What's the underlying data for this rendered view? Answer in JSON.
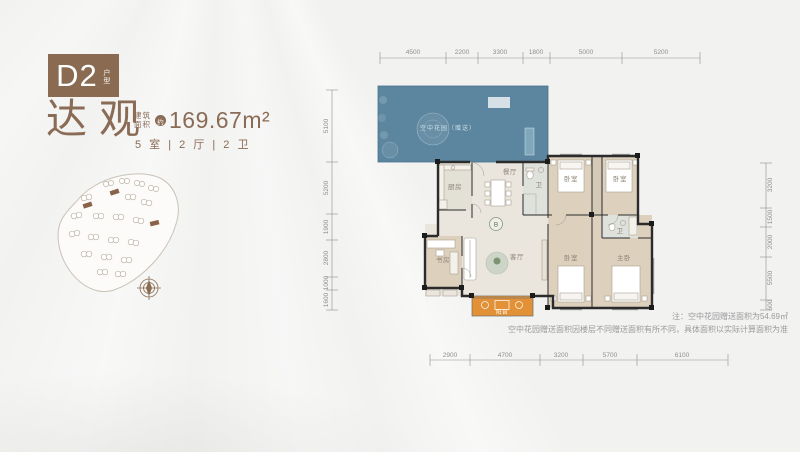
{
  "badge": {
    "code": "D2",
    "type_label": "户型"
  },
  "title": {
    "name": "达观",
    "area_label_line1": "建筑",
    "area_label_line2": "面积",
    "approx": "约",
    "area_value": "169.67m²",
    "layout": "5 室 | 2 厅 | 2 卫"
  },
  "floorplan": {
    "rooms": {
      "terrace": "空中花园（赠送）",
      "kitchen": "厨房",
      "dining": "餐厅",
      "bath": "卫",
      "bedroom1": "卧室",
      "bedroom2": "卧室",
      "study": "书房",
      "living": "客厅",
      "balcony": "阳台",
      "bedroom3": "卧室",
      "master_bath": "卫",
      "master": "主卧",
      "core_marker": "B"
    },
    "dims": {
      "top": [
        "4500",
        "2200",
        "3300",
        "1800",
        "5000",
        "5200"
      ],
      "bottom": [
        "2900",
        "4700",
        "3200",
        "5700",
        "6100"
      ],
      "left": [
        "5100",
        "5200",
        "1900",
        "2800",
        "1000",
        "1600"
      ],
      "right": [
        "3200",
        "1500",
        "2000",
        "5500",
        "600"
      ]
    }
  },
  "notes": {
    "line1": "注：空中花园赠送面积为54.69㎡",
    "line2": "空中花园赠送面积因楼层不同赠送面积有所不同，具体面积以实际计算面积为准"
  },
  "colors": {
    "brand_brown": "#8a6b52",
    "terrace_blue": "#517e99",
    "balcony_orange": "#e29136",
    "wall": "#2b2b2b",
    "dim_gray": "#8f8f8f"
  }
}
